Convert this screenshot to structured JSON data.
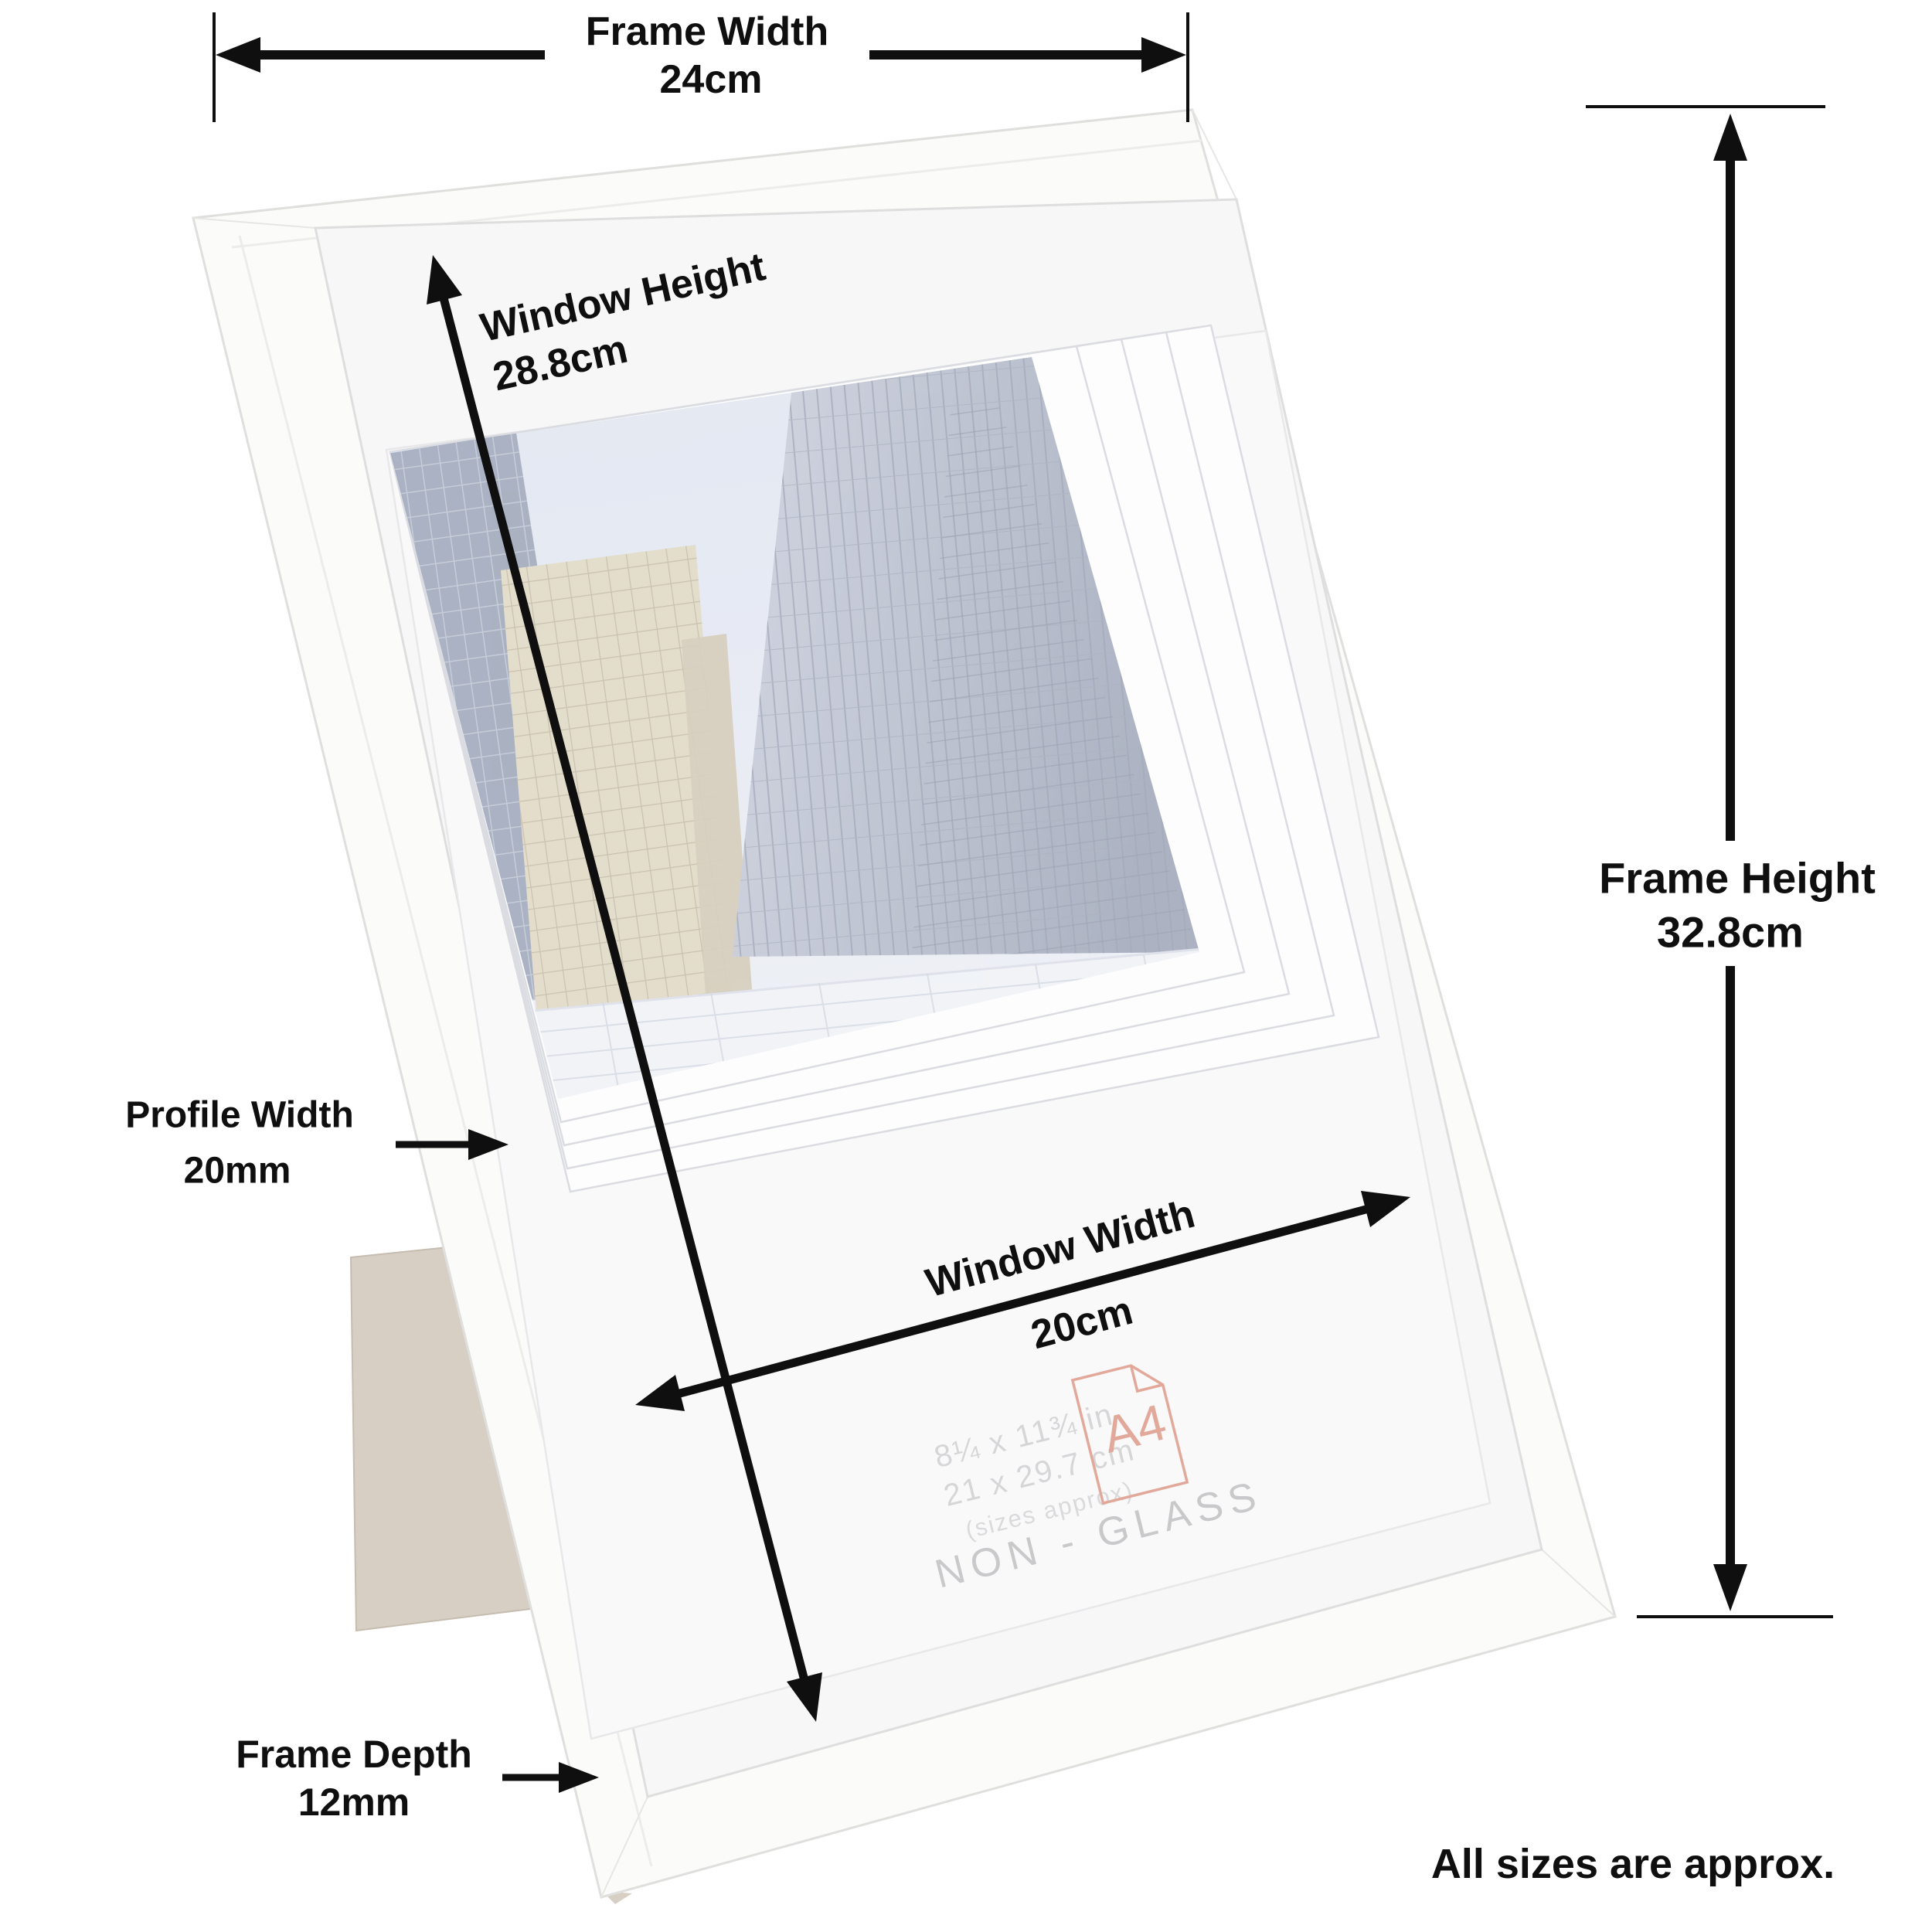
{
  "annotations": {
    "frame_width": {
      "label": "Frame Width",
      "value": "24cm"
    },
    "frame_height": {
      "label": "Frame Height",
      "value": "32.8cm"
    },
    "window_height": {
      "label": "Window Height",
      "value": "28.8cm"
    },
    "window_width": {
      "label": "Window Width",
      "value": "20cm"
    },
    "profile_width": {
      "label": "Profile Width",
      "value": "20mm"
    },
    "frame_depth": {
      "label": "Frame Depth",
      "value": "12mm"
    },
    "approx_note": "All sizes are approx."
  },
  "insert_label": {
    "size_inches": "8¼ x 11¾ in",
    "size_cm": "21 x 29.7 cm",
    "sizes_approx": "(sizes approx)",
    "paper_size": "A4",
    "glazing": "NON - GLASS"
  },
  "colors": {
    "annotation": "#0f0f0f",
    "frame": "#fbfbfa",
    "mat": "#f7f7f8",
    "insert_paper": "#fdfdfe",
    "sky": "#dfe4f0",
    "canopy": "#eef1f6",
    "easel": "#d7cfc4",
    "a4_accent": "#e2a89a",
    "faded_label": "#d6d6d8",
    "non_glass_label": "#c9c9cb"
  }
}
